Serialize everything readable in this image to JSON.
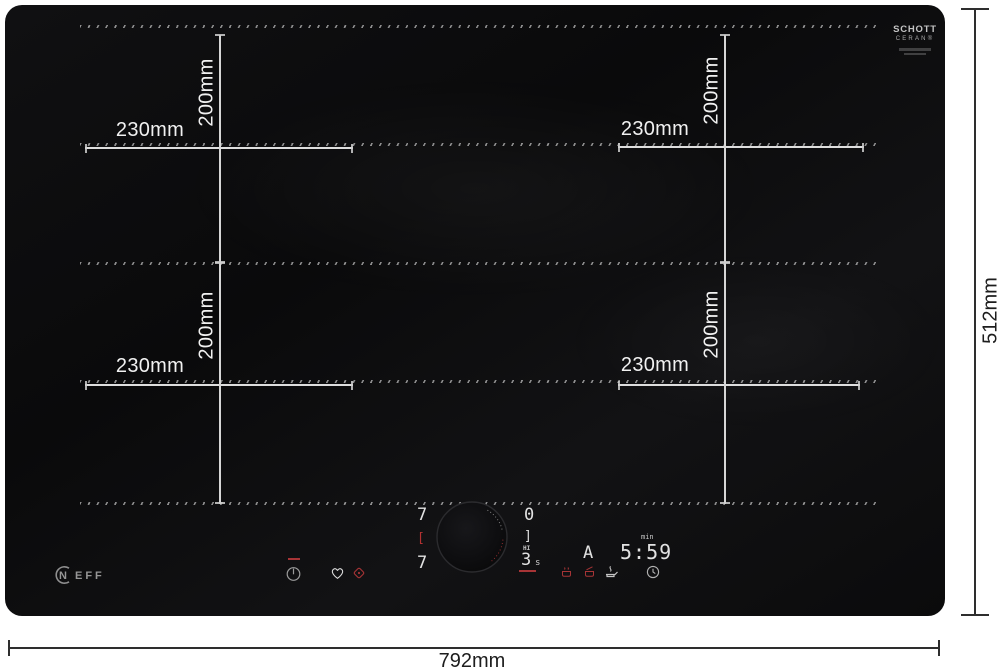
{
  "product": {
    "brand": "NEFF",
    "brand_initial": "N",
    "brand_rest": "EFF",
    "glass_logo": {
      "line1": "SCHOTT",
      "line2": "CERAN®"
    }
  },
  "dimensions": {
    "overall_width": "792mm",
    "overall_depth": "512mm",
    "zones": [
      {
        "position": "rear-left",
        "width": "230mm",
        "depth": "200mm"
      },
      {
        "position": "rear-right",
        "width": "230mm",
        "depth": "200mm"
      },
      {
        "position": "front-left",
        "width": "230mm",
        "depth": "200mm"
      },
      {
        "position": "front-right",
        "width": "230mm",
        "depth": "200mm"
      }
    ]
  },
  "control_panel": {
    "left_zone_display": {
      "rear_power": "7",
      "link_indicator": "[",
      "front_power": "7"
    },
    "right_zone_display": {
      "rear_power": "0",
      "link_indicator": "]",
      "boost_label": "HI",
      "front_power": "3",
      "front_power_unit": "s"
    },
    "function_display": "A",
    "timer": {
      "unit": "min",
      "value": "5:59"
    },
    "icon_names": [
      "power-icon",
      "heart-icon",
      "home-connect-icon",
      "keep-warm-icon",
      "melt-icon",
      "fry-sensor-icon",
      "timer-clock-icon",
      "knob"
    ]
  },
  "colors": {
    "surface": "#0c0c0e",
    "accent_red": "#a93434",
    "dimension_light": "#e6e6e6",
    "dimension_dark": "#2e2e2e"
  }
}
